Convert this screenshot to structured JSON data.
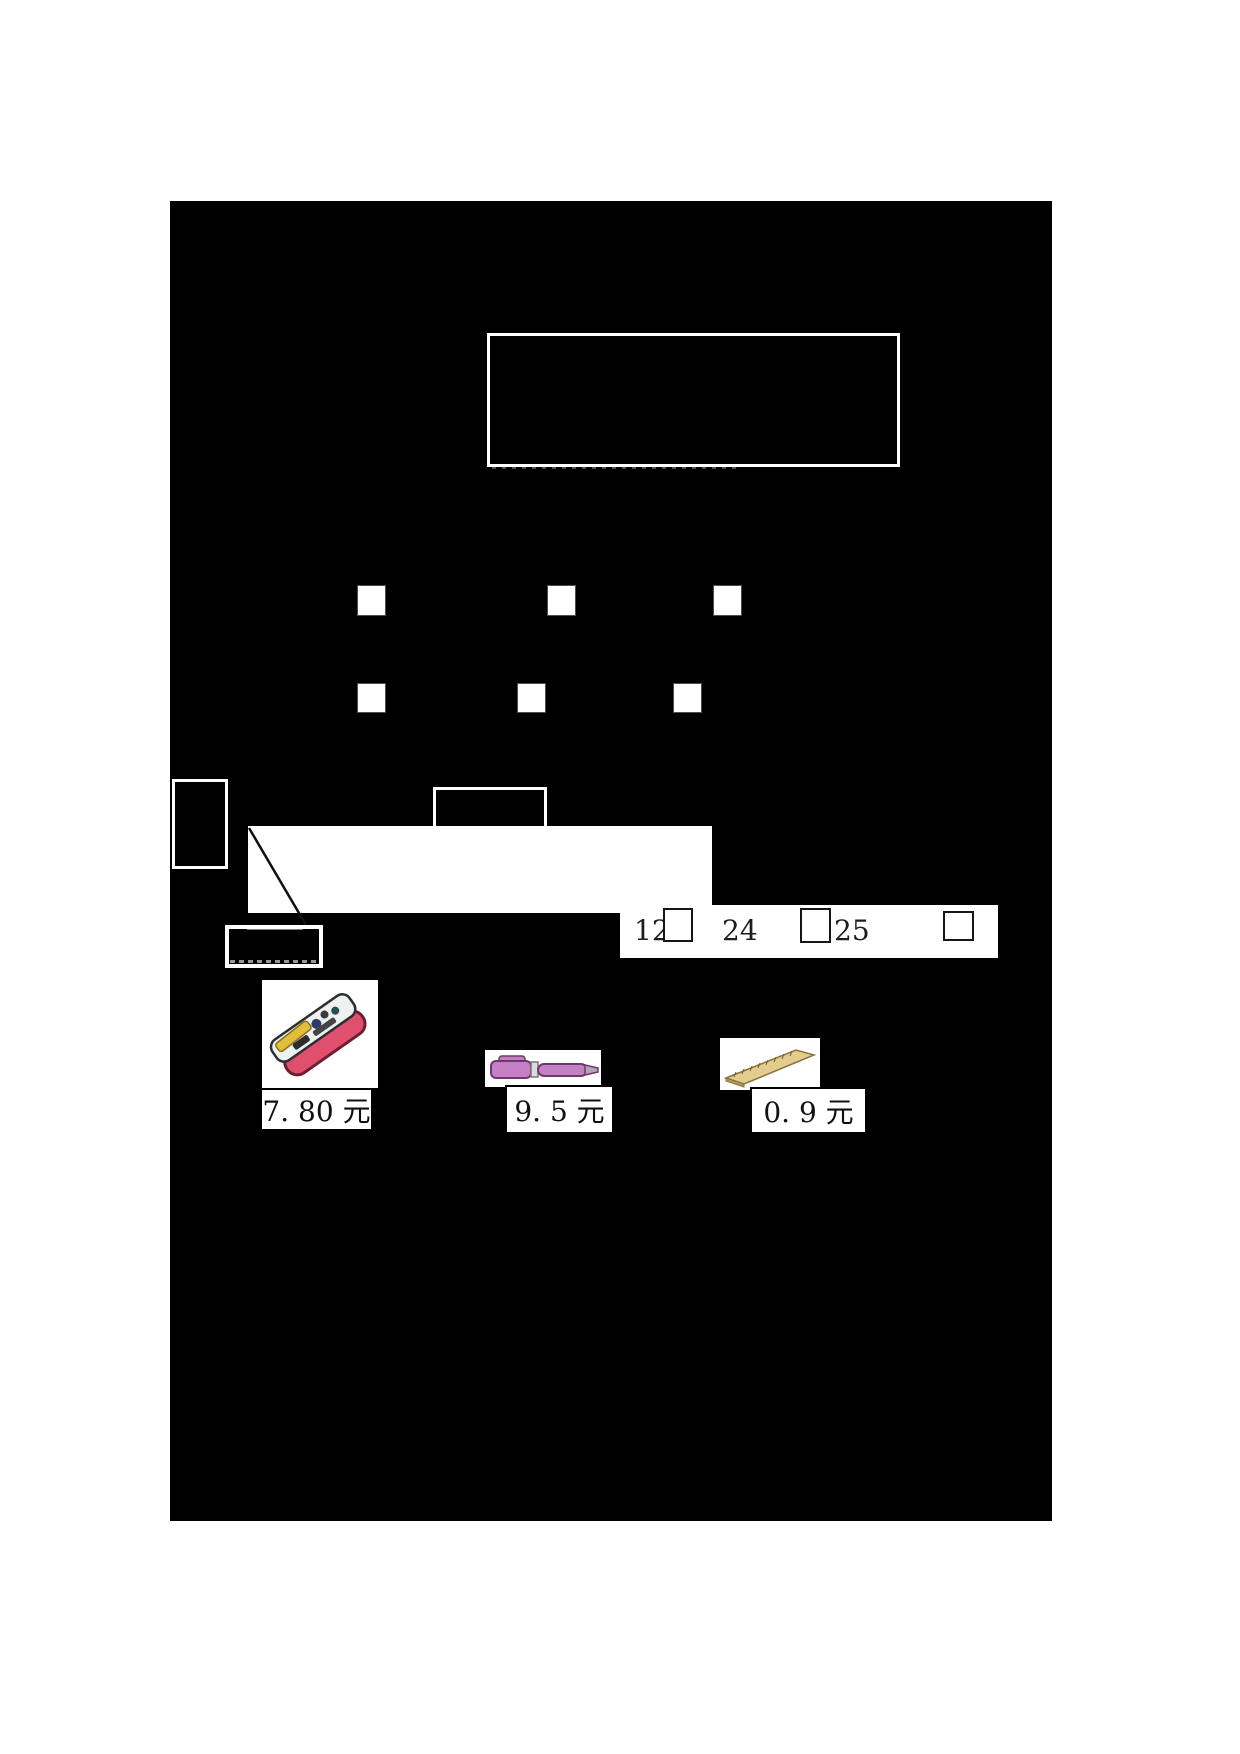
{
  "page": {
    "background": "#ffffff",
    "panel_color": "#000000",
    "kind": "math worksheet page (mostly redacted/blacked out)"
  },
  "sequence_strip": {
    "values": [
      "12",
      "24",
      "25"
    ],
    "answer_box_count": 3
  },
  "answer_squares": {
    "row1_count": 3,
    "row2_count": 3
  },
  "products": [
    {
      "icon": "pencil-case-icon",
      "price": "7. 80 元",
      "body_color": "#e0506e"
    },
    {
      "icon": "pen-icon",
      "price": "9. 5 元",
      "body_color": "#c57fc5"
    },
    {
      "icon": "ruler-icon",
      "price": "0. 9 元",
      "body_color": "#e2cc8e"
    }
  ],
  "colors": {
    "border_white": "#ffffff",
    "box_border_dark": "#161616",
    "square_border": "#4d4d4d"
  }
}
